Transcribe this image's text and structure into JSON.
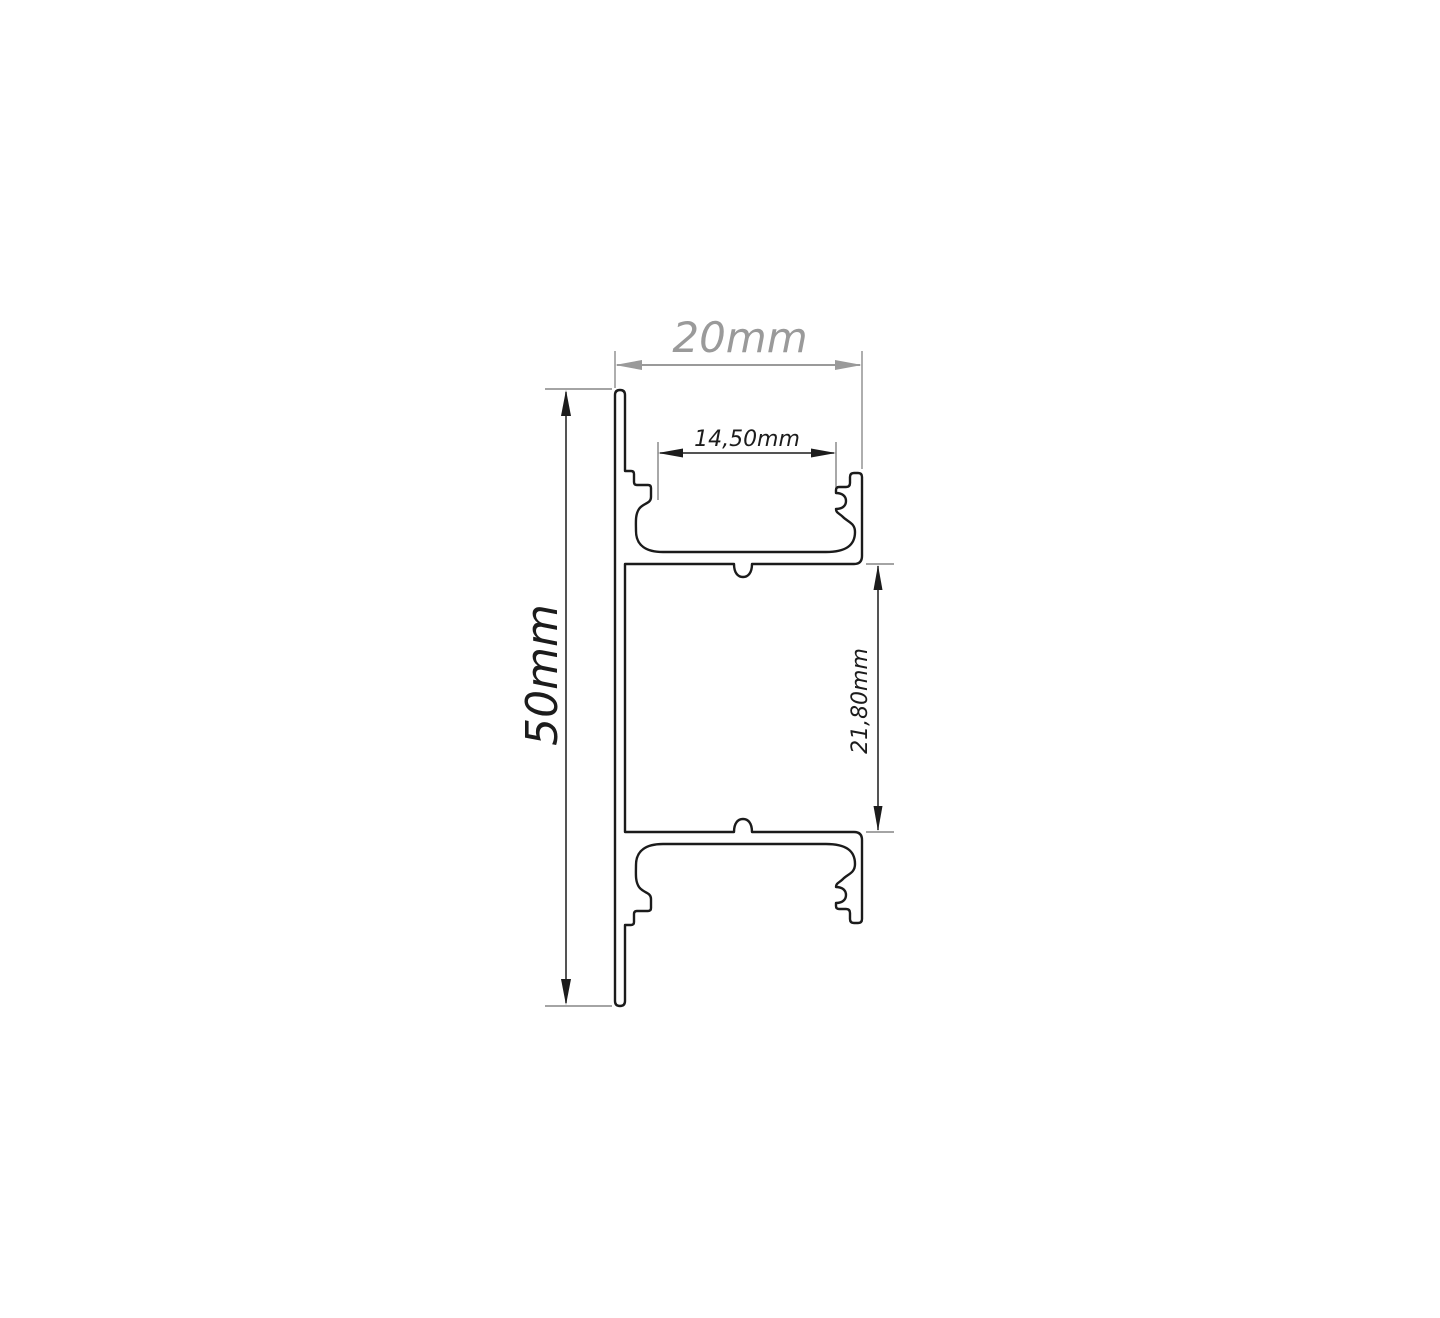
{
  "page": {
    "background": "#ffffff",
    "description": "Technical cross-section drawing of an aluminium LED mounting profile with dimension annotations"
  },
  "drawing": {
    "type": "profile-cross-section",
    "line_color": "#1b1b1b",
    "dim_color": "#1c1c1c",
    "muted_dim_color": "#9a9a9a",
    "labels": {
      "overall_width": "20mm",
      "overall_height": "50mm",
      "slot_width": "14,50mm",
      "cavity_height": "21,80mm"
    }
  }
}
